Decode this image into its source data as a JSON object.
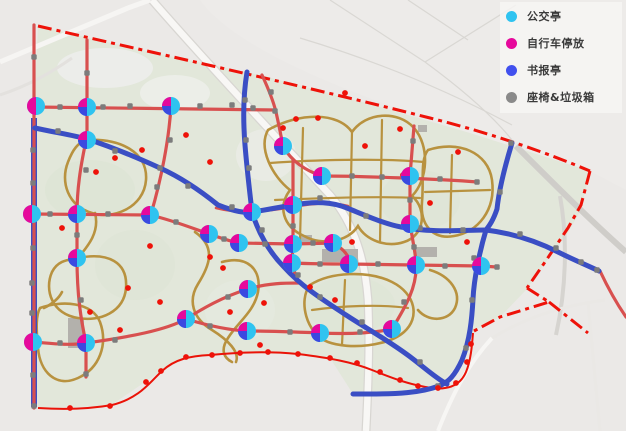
{
  "legend": {
    "items": [
      {
        "name": "bus-kiosk",
        "label": "公交亭",
        "color": "#2fc3f0"
      },
      {
        "name": "bicycle-parking",
        "label": "自行车停放",
        "color": "#e6099c"
      },
      {
        "name": "newsstand",
        "label": "书报亭",
        "color": "#4150ee"
      },
      {
        "name": "bench-and-trash",
        "label": "座椅&垃圾箱",
        "color": "#8a8a8a"
      }
    ]
  },
  "map": {
    "marker_radius": 9,
    "colors": {
      "cyan": "#2fc3f0",
      "magenta": "#e6099c",
      "blue": "#3b49e0",
      "gray_dot": "#7c7c7c",
      "red_dot": "#ee1209",
      "road_red": "#d8504f",
      "path_blue": "#3a4ec4",
      "path_tan": "#b8923f",
      "boundary_red": "#ee1209"
    },
    "markers": [
      {
        "x": 36,
        "y": 106,
        "t": "mc"
      },
      {
        "x": 87,
        "y": 107,
        "t": "mcb"
      },
      {
        "x": 171,
        "y": 106,
        "t": "mcb"
      },
      {
        "x": 87,
        "y": 140,
        "t": "mcb"
      },
      {
        "x": 283,
        "y": 146,
        "t": "mcb"
      },
      {
        "x": 322,
        "y": 176,
        "t": "mcb"
      },
      {
        "x": 410,
        "y": 176,
        "t": "mcb"
      },
      {
        "x": 252,
        "y": 212,
        "t": "mcb"
      },
      {
        "x": 293,
        "y": 205,
        "t": "mcb"
      },
      {
        "x": 32,
        "y": 214,
        "t": "mc"
      },
      {
        "x": 77,
        "y": 214,
        "t": "mcb"
      },
      {
        "x": 150,
        "y": 215,
        "t": "mcb"
      },
      {
        "x": 209,
        "y": 234,
        "t": "mcb"
      },
      {
        "x": 239,
        "y": 243,
        "t": "mcb"
      },
      {
        "x": 293,
        "y": 244,
        "t": "mcb"
      },
      {
        "x": 292,
        "y": 263,
        "t": "mcb"
      },
      {
        "x": 333,
        "y": 243,
        "t": "mcb"
      },
      {
        "x": 349,
        "y": 264,
        "t": "mcb"
      },
      {
        "x": 410,
        "y": 224,
        "t": "mcb"
      },
      {
        "x": 416,
        "y": 265,
        "t": "mcb"
      },
      {
        "x": 481,
        "y": 266,
        "t": "mcb"
      },
      {
        "x": 77,
        "y": 258,
        "t": "mcb"
      },
      {
        "x": 248,
        "y": 289,
        "t": "mcb"
      },
      {
        "x": 186,
        "y": 319,
        "t": "mcb"
      },
      {
        "x": 33,
        "y": 342,
        "t": "mc"
      },
      {
        "x": 86,
        "y": 343,
        "t": "mcb"
      },
      {
        "x": 247,
        "y": 331,
        "t": "mcb"
      },
      {
        "x": 320,
        "y": 333,
        "t": "mcb"
      },
      {
        "x": 392,
        "y": 329,
        "t": "mcb"
      }
    ],
    "gray_dots": [
      [
        60,
        107
      ],
      [
        103,
        107
      ],
      [
        130,
        106
      ],
      [
        200,
        106
      ],
      [
        232,
        105
      ],
      [
        253,
        108
      ],
      [
        34,
        57
      ],
      [
        33,
        150
      ],
      [
        33,
        183
      ],
      [
        33,
        248
      ],
      [
        32,
        283
      ],
      [
        32,
        313
      ],
      [
        33,
        375
      ],
      [
        34,
        406
      ],
      [
        87,
        73
      ],
      [
        86,
        170
      ],
      [
        77,
        235
      ],
      [
        81,
        300
      ],
      [
        86,
        374
      ],
      [
        170,
        140
      ],
      [
        157,
        187
      ],
      [
        271,
        92
      ],
      [
        275,
        111
      ],
      [
        352,
        176
      ],
      [
        382,
        177
      ],
      [
        440,
        179
      ],
      [
        477,
        182
      ],
      [
        413,
        141
      ],
      [
        410,
        200
      ],
      [
        414,
        247
      ],
      [
        404,
        302
      ],
      [
        360,
        332
      ],
      [
        290,
        332
      ],
      [
        210,
        326
      ],
      [
        60,
        343
      ],
      [
        115,
        340
      ],
      [
        50,
        214
      ],
      [
        108,
        214
      ],
      [
        176,
        222
      ],
      [
        224,
        239
      ],
      [
        265,
        244
      ],
      [
        313,
        243
      ],
      [
        320,
        264
      ],
      [
        378,
        264
      ],
      [
        445,
        266
      ],
      [
        497,
        267
      ],
      [
        293,
        226
      ],
      [
        298,
        275
      ],
      [
        228,
        297
      ],
      [
        262,
        230
      ],
      [
        287,
        264
      ],
      [
        320,
        297
      ],
      [
        362,
        322
      ],
      [
        420,
        362
      ],
      [
        58,
        131
      ],
      [
        115,
        151
      ],
      [
        160,
        168
      ],
      [
        188,
        186
      ],
      [
        232,
        207
      ],
      [
        320,
        198
      ],
      [
        366,
        216
      ],
      [
        420,
        228
      ],
      [
        463,
        230
      ],
      [
        520,
        234
      ],
      [
        556,
        248
      ],
      [
        581,
        262
      ],
      [
        597,
        270
      ],
      [
        474,
        258
      ],
      [
        472,
        300
      ],
      [
        466,
        348
      ],
      [
        438,
        386
      ],
      [
        511,
        143
      ],
      [
        500,
        192
      ],
      [
        245,
        100
      ],
      [
        246,
        140
      ],
      [
        249,
        168
      ]
    ],
    "red_dots": [
      [
        115,
        158
      ],
      [
        96,
        172
      ],
      [
        142,
        150
      ],
      [
        345,
        93
      ],
      [
        296,
        119
      ],
      [
        318,
        118
      ],
      [
        365,
        146
      ],
      [
        400,
        129
      ],
      [
        403,
        175
      ],
      [
        430,
        203
      ],
      [
        458,
        152
      ],
      [
        467,
        242
      ],
      [
        352,
        242
      ],
      [
        310,
        287
      ],
      [
        264,
        303
      ],
      [
        223,
        268
      ],
      [
        210,
        257
      ],
      [
        150,
        246
      ],
      [
        128,
        288
      ],
      [
        62,
        228
      ],
      [
        90,
        312
      ],
      [
        120,
        330
      ],
      [
        160,
        302
      ],
      [
        230,
        312
      ],
      [
        260,
        345
      ],
      [
        335,
        300
      ],
      [
        186,
        135
      ],
      [
        210,
        162
      ],
      [
        283,
        128
      ],
      [
        70,
        408
      ],
      [
        110,
        406
      ],
      [
        146,
        382
      ],
      [
        161,
        371
      ],
      [
        186,
        357
      ],
      [
        212,
        355
      ],
      [
        240,
        353
      ],
      [
        268,
        352
      ],
      [
        298,
        354
      ],
      [
        330,
        358
      ],
      [
        357,
        363
      ],
      [
        380,
        372
      ],
      [
        400,
        380
      ],
      [
        418,
        386
      ],
      [
        438,
        388
      ],
      [
        456,
        383
      ],
      [
        467,
        362
      ],
      [
        471,
        344
      ]
    ]
  }
}
